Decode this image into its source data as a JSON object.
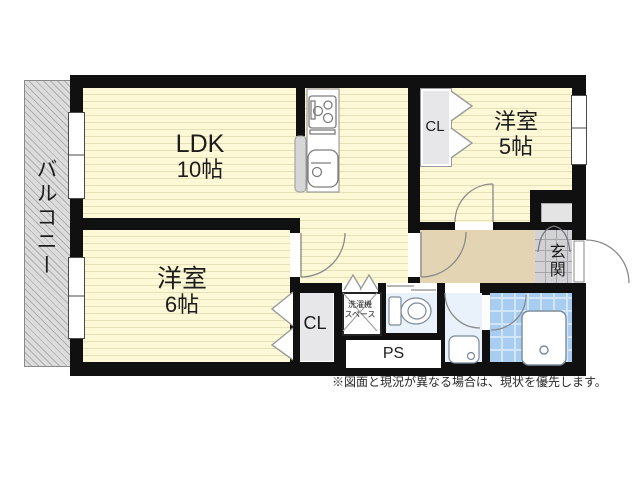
{
  "floorplan": {
    "balcony": {
      "label": "バルコニー"
    },
    "ldk": {
      "name": "LDK",
      "size": "10帖"
    },
    "bedroom_5": {
      "name": "洋室",
      "size": "5帖"
    },
    "bedroom_6": {
      "name": "洋室",
      "size": "6帖"
    },
    "closet_upper": {
      "label": "CL"
    },
    "closet_lower": {
      "label": "CL"
    },
    "pipe_space": {
      "label": "PS"
    },
    "washer_space": {
      "line1": "洗濯機",
      "line2": "スペース"
    },
    "entrance": {
      "label": "玄関"
    },
    "note": "※図面と現況が異なる場合は、現状を優先します。",
    "colors": {
      "wall": "#101010",
      "room_floor": "#fdf8d6",
      "hallway": "#e3d5b3",
      "balcony": "#dcdcdc",
      "closet": "#e7e7ea",
      "entrance_tile": "#d2d2d5",
      "utility_floor": "#e9f2fa",
      "bathroom_tile": "#a9cdf1"
    }
  }
}
